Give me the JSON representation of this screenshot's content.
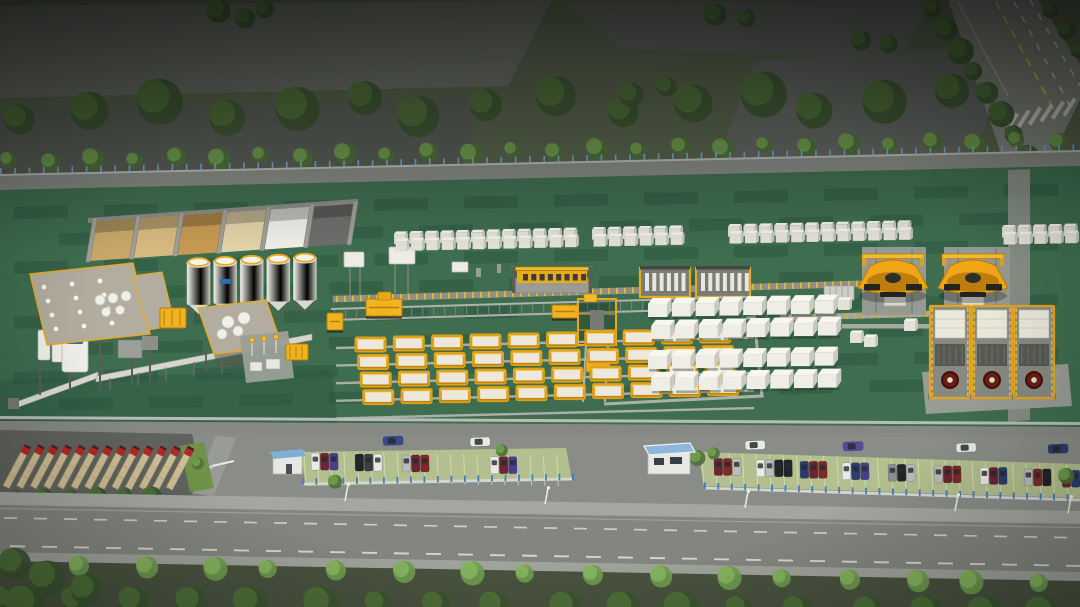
{
  "scene": {
    "subject": "aerial-3d-render-precast-concrete-block-factory",
    "canvas_width": 1080,
    "canvas_height": 607
  },
  "colors": {
    "apron": "#8a8d87",
    "grass_top": "#57614b",
    "slab_light": "#6a6e67",
    "slab_mid": "#616560",
    "slab_dark": "#575b54",
    "yard": "#3e6d4f",
    "yard_dark": "#2c5640",
    "boundary": "#868983",
    "boundary_hi": "#b9bcb6",
    "path_light": "#8e918a",
    "pad_gray": "#999c95",
    "tree_dark": "#3c5531",
    "tree_mid": "#4e7038",
    "tree_bright": "#6f9c4e",
    "tree_hi": "#86b35e",
    "verge": "#49523f",
    "fence_blue": "#3f7fc0",
    "fence_blue_light": "#7ab0d8",
    "fence_rail": "#d4d6d0",
    "road": "#83867f",
    "road_line": "#d8dad4",
    "road_line_yellow": "#d9b54a",
    "sidewalk": "#a4a7a0",
    "sidewalk_far": "#a0a39c",
    "pavement_dark": "#5f625d",
    "paver_green": "#b5c28e",
    "paver_line": "#d9e3b4",
    "white_block_top": "#f3f3ea",
    "white_block_front": "#e2e2d8",
    "white_block_side": "#c4c4bb",
    "big_block_front": "#eeeee6",
    "big_block_top": "#f7f7f0",
    "big_block_side": "#c9c9c0",
    "silo_white": "#f1f1ea",
    "silo_shade": "#cfcfc6",
    "plant_roof": "#b3ad9f",
    "machine_gray": "#9a9d95",
    "machine_body": "#787c74",
    "steel_dark": "#5a5d55",
    "yellow": "#e9a91c",
    "yellow_bright": "#f2bc2a",
    "yellow_deep": "#b97c08",
    "cart_yellow": "#f0b322",
    "carrier_yellow": "#f0a616",
    "mold_face": "#ece9dc",
    "mold_frame": "#e1a117",
    "rail_gray": "#b0b3ac",
    "track_gray": "#989b94",
    "truck_cab": "#b32822",
    "truck_trailer": "#cdbd94",
    "guard_roof": "#7fb0d4",
    "guard_roof2": "#8fb8d8",
    "guard_wall": "#e7e8e4",
    "logo_blue": "#2e6db4",
    "wheel_red": "#6b1d12",
    "cab_dark": "#23241f",
    "glass_dark": "#252a30",
    "grass_gate": "#6f9148"
  },
  "palette_cars": {
    "white": "#e9eae8",
    "silver": "#b9bcbd",
    "black": "#20242a",
    "charcoal": "#3a3e44",
    "maroon": "#6e2433",
    "darkred": "#7e2a28",
    "purple": "#4a3f8c",
    "navy": "#2c3c72",
    "blue": "#3a4a8c",
    "violet": "#5a4a9a",
    "gray": "#8b8f93"
  },
  "vegetation": {
    "top_bush_count": 16,
    "top_tree_row_count": 26,
    "diag_road_tree_count": 8,
    "verge_tree_count": 17,
    "bottom_tree_count": 18,
    "truck_lot_tree_count": 6
  },
  "site": {
    "aggregate_bays": {
      "count": 6,
      "materials": [
        "#c8a869",
        "#d6ba80",
        "#c79a52",
        "#e3d3a8",
        "#efefe8",
        "#6e6e6c"
      ]
    },
    "cement_silos": {
      "count": 5,
      "logo_silo_index": 1
    },
    "batching_plant": {
      "roof_vent_count": 12,
      "roof_tank_count": 5,
      "under_silo_count": 3
    },
    "mixing_platform": {
      "tank_count": 4
    },
    "transformer_station": {
      "pole_count": 3,
      "cabinet_count": 2
    },
    "production_line": {
      "machine_window_count": 8,
      "tick_count": 68
    },
    "transfer_carts": {
      "count": 3
    },
    "mold_grid": {
      "rows": 4,
      "columns": 10
    },
    "block_stacks_top": {
      "row_count": 2,
      "groups": [
        {
          "start_x": 394,
          "count": 12
        },
        {
          "start_x": 592,
          "count": 6
        },
        {
          "start_x": 728,
          "count": 12
        },
        {
          "start_x": 1002,
          "count": 5
        }
      ]
    },
    "block_stacks_mid": {
      "band_count": 2,
      "columns": 8,
      "rows": 2
    },
    "straddle_carriers": {
      "count": 2
    },
    "finishing_machines": {
      "count": 3
    }
  },
  "south": {
    "trucks": {
      "count": 13
    },
    "street_cars": [
      {
        "x": 383,
        "color": "blue"
      },
      {
        "x": 470,
        "color": "white"
      },
      {
        "x": 745,
        "color": "white"
      },
      {
        "x": 843,
        "color": "violet"
      },
      {
        "x": 956,
        "color": "white"
      },
      {
        "x": 1048,
        "color": "navy"
      }
    ],
    "parking_north_clusters": [
      {
        "x": 311,
        "cars": [
          "white",
          "maroon",
          "purple"
        ]
      },
      {
        "x": 355,
        "cars": [
          "black",
          "charcoal",
          "white"
        ]
      },
      {
        "x": 402,
        "cars": [
          "silver",
          "maroon",
          "darkred"
        ]
      },
      {
        "x": 490,
        "cars": [
          "white",
          "maroon",
          "purple"
        ]
      }
    ],
    "parking_south_clusters": [
      {
        "x": 714,
        "cars": [
          "maroon",
          "darkred",
          "silver"
        ]
      },
      {
        "x": 756,
        "cars": [
          "white",
          "silver",
          "black",
          "black"
        ]
      },
      {
        "x": 800,
        "cars": [
          "navy",
          "maroon",
          "darkred"
        ]
      },
      {
        "x": 842,
        "cars": [
          "white",
          "navy",
          "purple"
        ]
      },
      {
        "x": 888,
        "cars": [
          "gray",
          "black",
          "silver"
        ]
      },
      {
        "x": 934,
        "cars": [
          "silver",
          "maroon",
          "darkred"
        ]
      },
      {
        "x": 980,
        "cars": [
          "white",
          "maroon",
          "navy"
        ]
      },
      {
        "x": 1024,
        "cars": [
          "silver",
          "darkred",
          "black"
        ]
      },
      {
        "x": 1062,
        "cars": [
          "maroon",
          "navy"
        ]
      }
    ],
    "guardhouse_count": 2,
    "fence_post_step": 13,
    "streetlight_xs": [
      345,
      545,
      745,
      955,
      1068
    ],
    "road_dash_rows": 2
  }
}
